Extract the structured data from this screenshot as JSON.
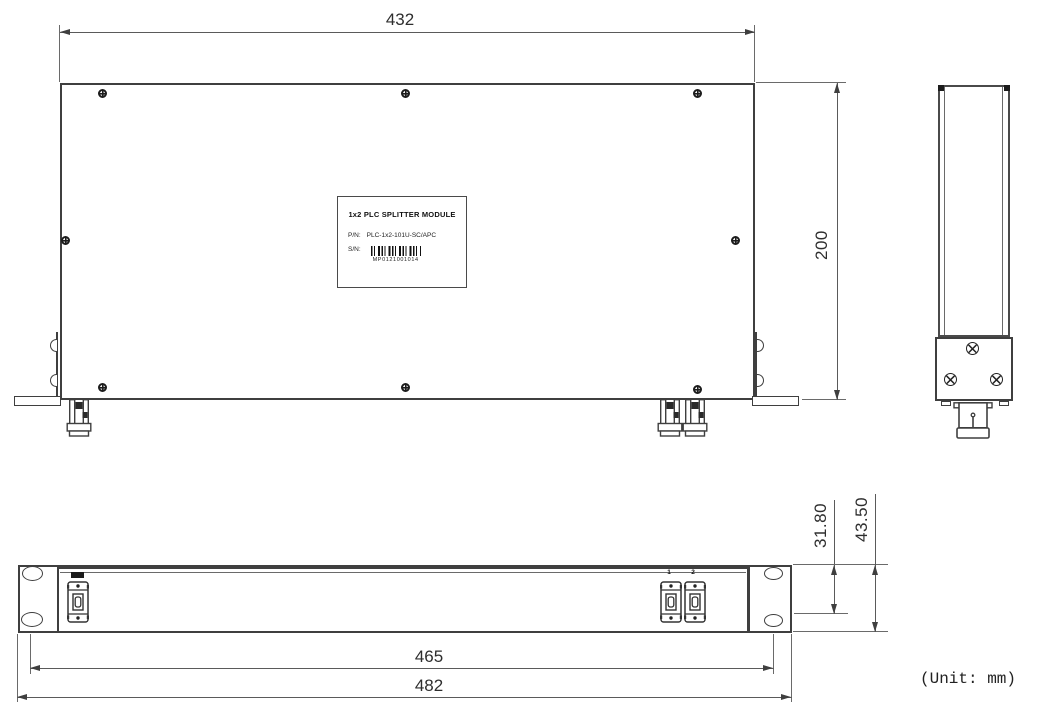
{
  "drawing": {
    "unit_note": "(Unit: mm)",
    "top_view": {
      "width": "432",
      "depth": "200"
    },
    "front_view": {
      "inner_width": "465",
      "outer_width": "482",
      "inner_height": "31.80",
      "outer_height": "43.50",
      "port_labels": [
        "1",
        "2"
      ]
    },
    "product_label": {
      "title": "1x2 PLC SPLITTER MODULE",
      "pn_label": "P/N:",
      "pn_value": "PLC-1x2-101U-SC/APC",
      "sn_label": "S/N:",
      "sn_value": "MP0121001014"
    },
    "colors": {
      "object_line": "#3f3f3f",
      "dim_line": "#5a5a5a"
    }
  }
}
